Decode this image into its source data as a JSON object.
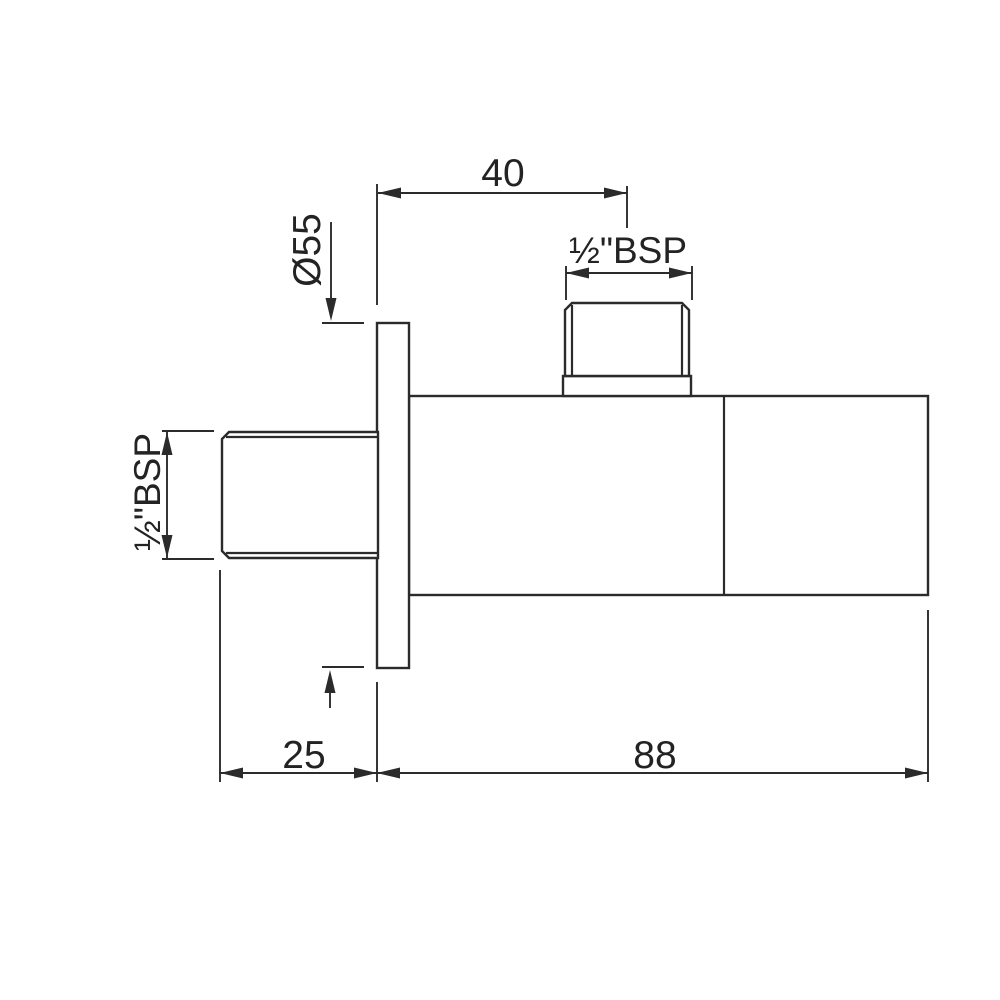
{
  "drawing": {
    "type": "technical-dimension-drawing",
    "subject": "angle-valve-side-view",
    "colors": {
      "line": "#2b2b2b",
      "text": "#232323",
      "background": "#ffffff"
    },
    "labels": {
      "dim_top_offset": "40",
      "dim_plate_diameter": "Ø55",
      "dim_top_thread": "½\"BSP",
      "dim_left_thread": "½\"BSP",
      "dim_plate_depth": "25",
      "dim_body_length": "88"
    }
  }
}
